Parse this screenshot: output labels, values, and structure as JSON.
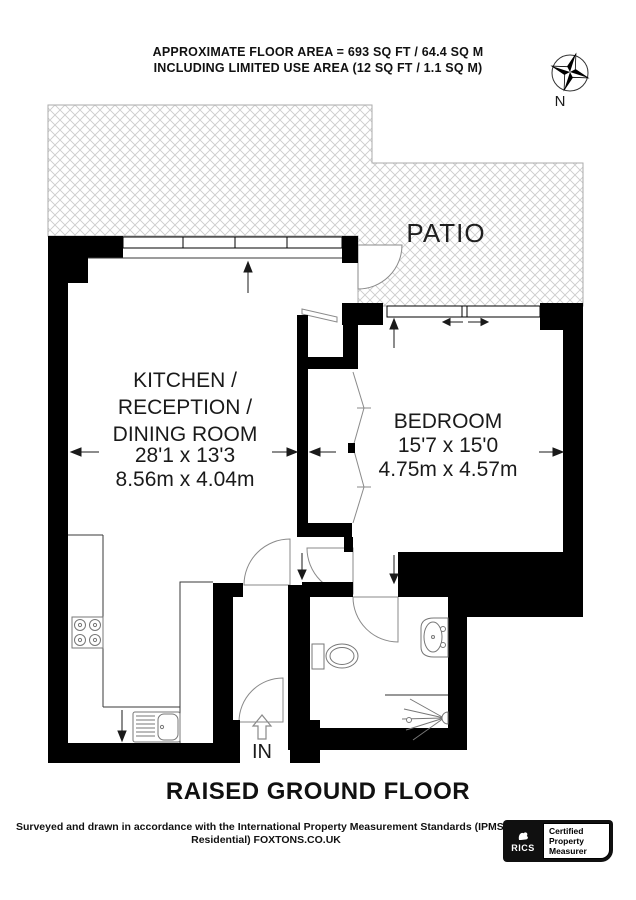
{
  "header": {
    "line1": "APPROXIMATE FLOOR AREA = 693 SQ FT / 64.4 SQ M",
    "line2": "INCLUDING LIMITED USE AREA (12 SQ FT / 1.1 SQ M)"
  },
  "compass": {
    "label": "N"
  },
  "rooms": {
    "patio": {
      "name": "PATIO"
    },
    "kitchen": {
      "name_line1": "KITCHEN /",
      "name_line2": "RECEPTION /",
      "name_line3": "DINING ROOM",
      "dims_imperial": "28'1 x 13'3",
      "dims_metric": "8.56m x 4.04m"
    },
    "bedroom": {
      "name": "BEDROOM",
      "dims_imperial": "15'7 x 15'0",
      "dims_metric": "4.75m x 4.57m"
    }
  },
  "entrance": {
    "label": "IN"
  },
  "floor_title": "RAISED GROUND FLOOR",
  "footer": {
    "line1": "Surveyed and drawn in accordance with the International Property Measurement Standards (IPMS 2:",
    "line2": "Residential) FOXTONS.CO.UK"
  },
  "badge": {
    "org": "RICS",
    "cert_line1": "Certified",
    "cert_line2": "Property",
    "cert_line3": "Measurer"
  },
  "colors": {
    "wall": "#000000",
    "hatch": "#cccccc",
    "text": "#1a1a1a"
  }
}
